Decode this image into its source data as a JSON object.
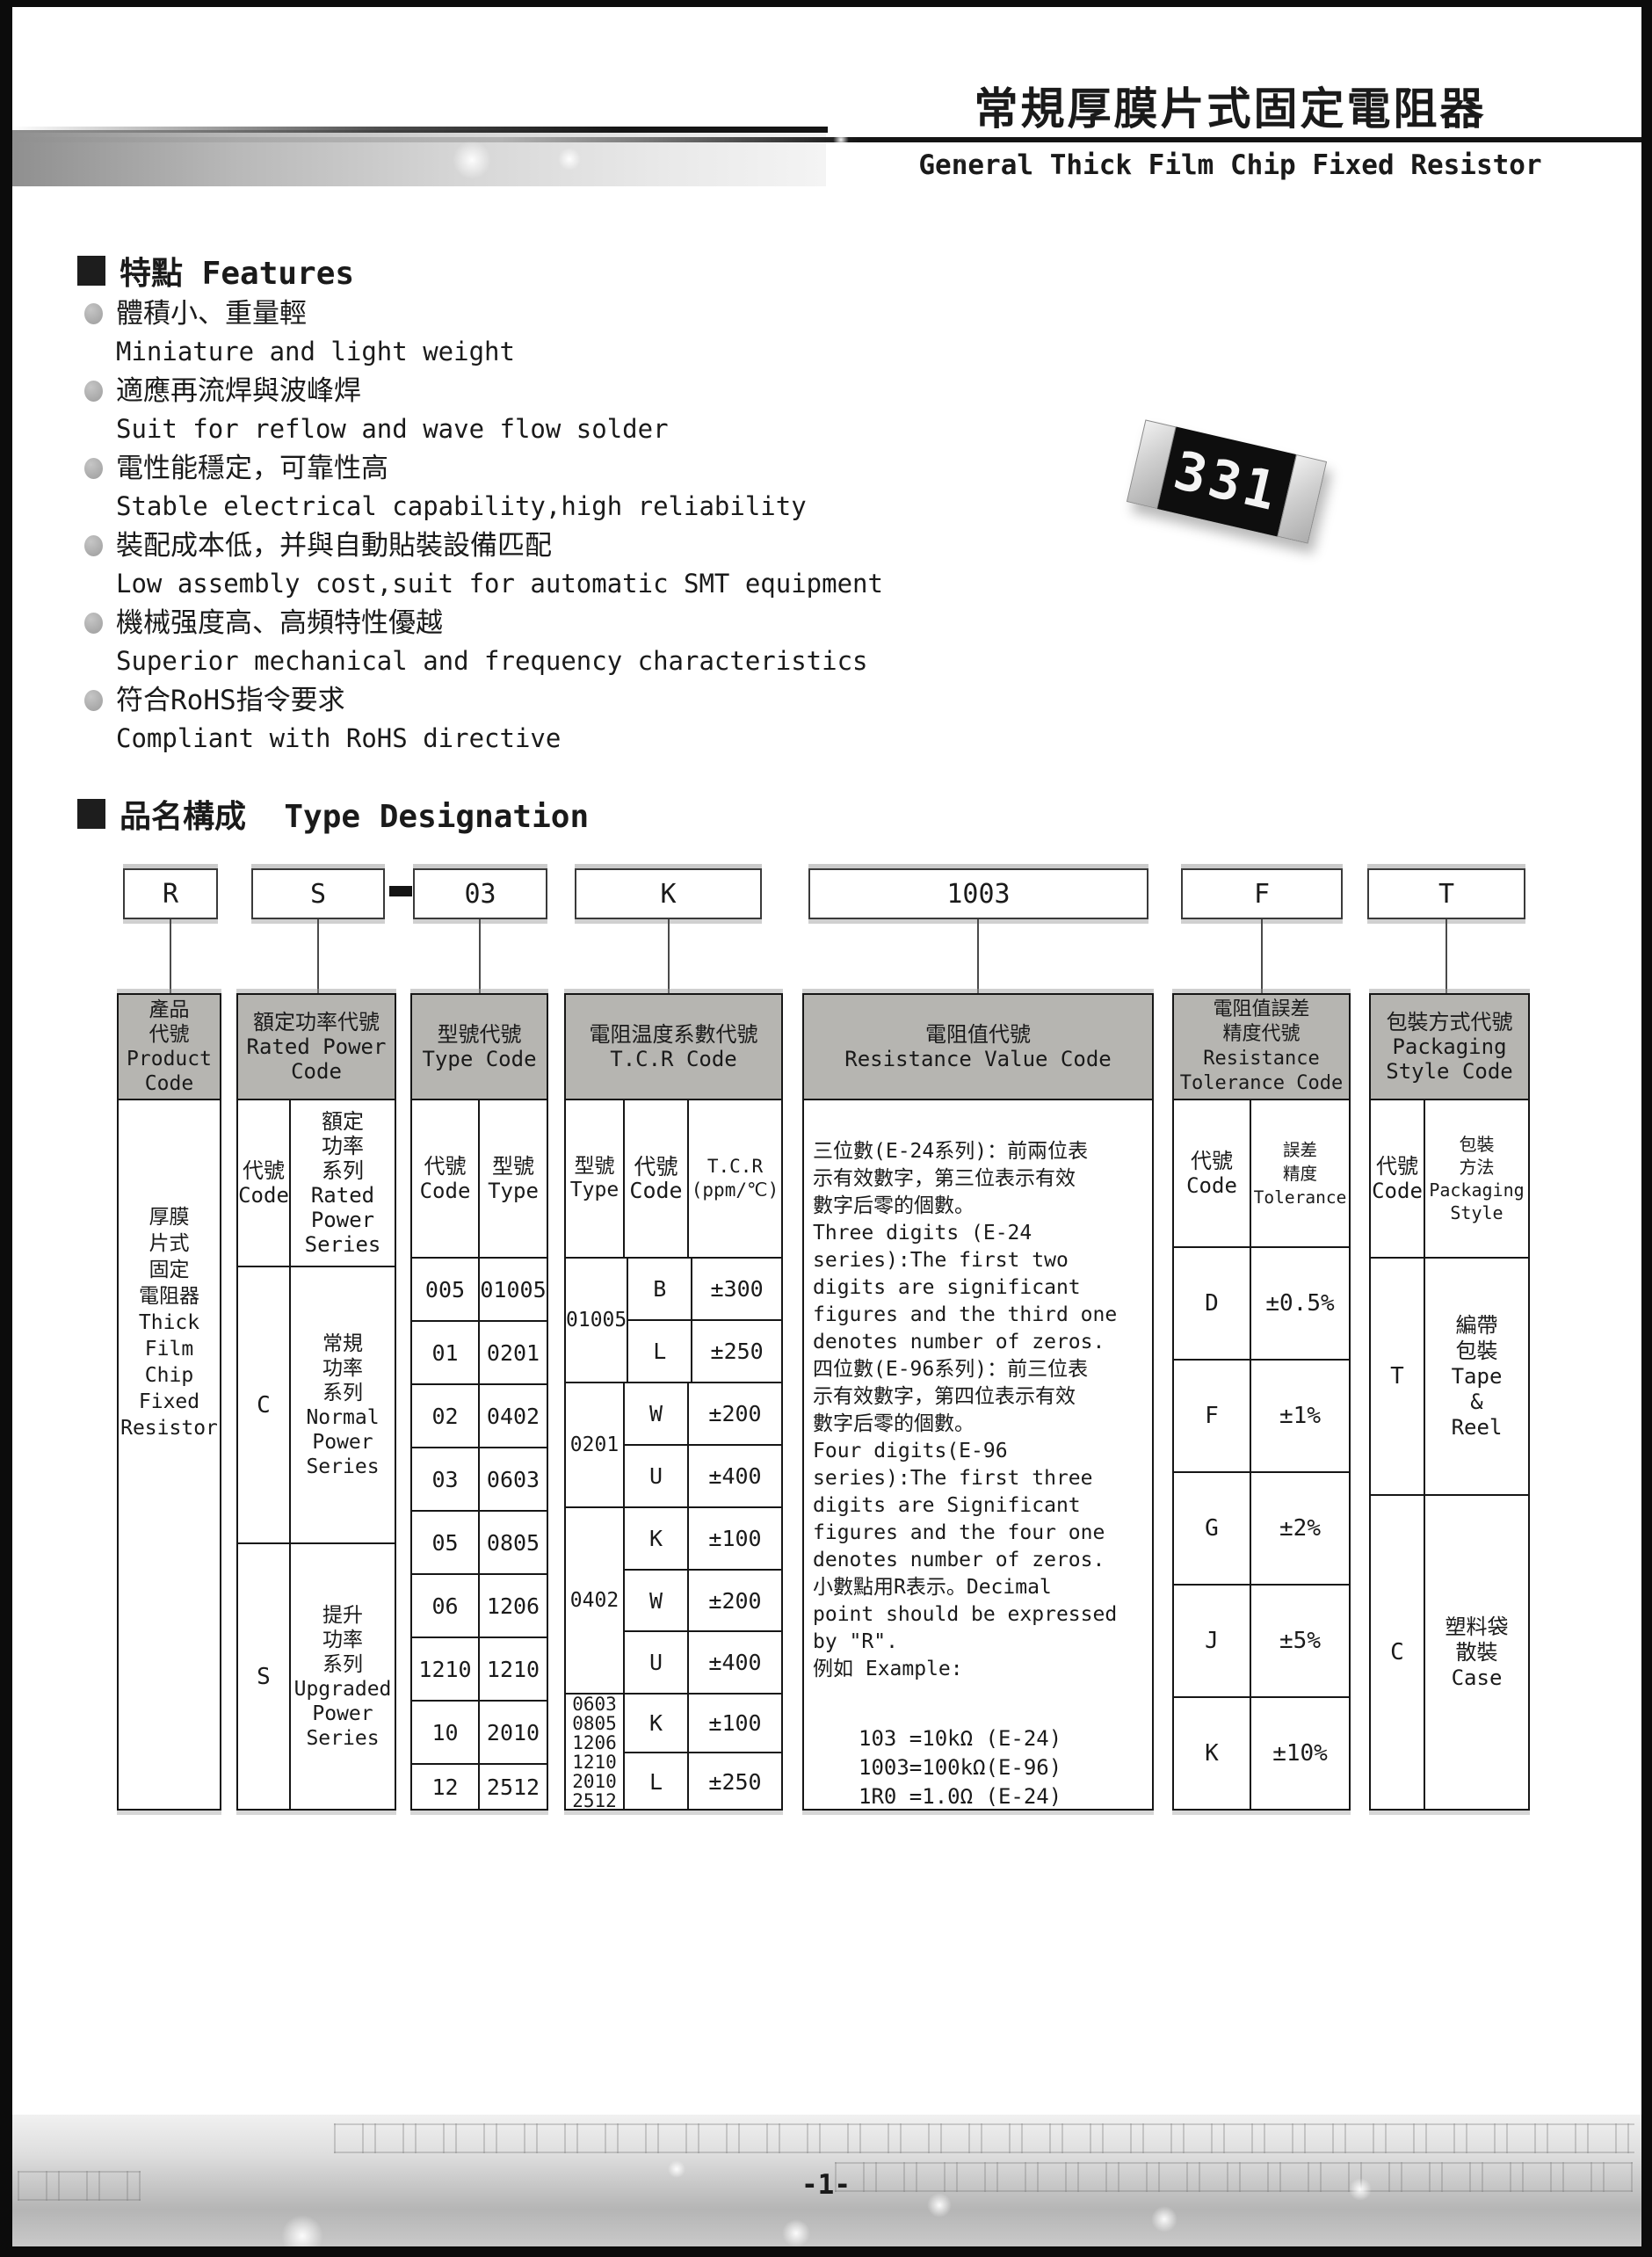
{
  "header": {
    "title_cn": "常規厚膜片式固定電阻器",
    "title_en": "General Thick Film Chip Fixed Resistor"
  },
  "features": {
    "heading": "特點 Features",
    "items": [
      {
        "cn": "體積小、重量輕",
        "en": "Miniature and light weight"
      },
      {
        "cn": "適應再流焊與波峰焊",
        "en": "Suit for reflow and wave flow solder"
      },
      {
        "cn": "電性能穩定，可靠性高",
        "en": "Stable electrical capability,high reliability"
      },
      {
        "cn": "裝配成本低，并與自動貼裝設備匹配",
        "en": "Low assembly cost,suit for automatic SMT equipment"
      },
      {
        "cn": "機械强度高、高頻特性優越",
        "en": "Superior mechanical and frequency characteristics"
      },
      {
        "cn": "符合RoHS指令要求",
        "en": "Compliant with RoHS directive"
      }
    ],
    "resistor_marking": "331"
  },
  "type_designation": {
    "heading": "品名構成  Type Designation",
    "code_boxes": {
      "product": "R",
      "power": "S",
      "separator": "-",
      "type": "03",
      "tcr": "K",
      "resistance": "1003",
      "tolerance": "F",
      "packaging": "T"
    },
    "product_code": {
      "header": "產品\n代號\nProduct\nCode",
      "body": "厚膜\n片式\n固定\n電阻器\nThick\nFilm\nChip\nFixed\nResistor"
    },
    "rated_power": {
      "header": "額定功率代號\nRated Power\nCode",
      "sub_code": "代號\nCode",
      "sub_series": "額定\n功率\n系列\nRated\nPower\nSeries",
      "rows": [
        {
          "code": "C",
          "series": "常規\n功率\n系列\nNormal\nPower\nSeries"
        },
        {
          "code": "S",
          "series": "提升\n功率\n系列\nUpgraded\nPower\nSeries"
        }
      ]
    },
    "type_code": {
      "header": "型號代號\nType Code",
      "sub_code": "代號\nCode",
      "sub_type": "型號\nType",
      "rows": [
        [
          "005",
          "01005"
        ],
        [
          "01",
          "0201"
        ],
        [
          "02",
          "0402"
        ],
        [
          "03",
          "0603"
        ],
        [
          "05",
          "0805"
        ],
        [
          "06",
          "1206"
        ],
        [
          "1210",
          "1210"
        ],
        [
          "10",
          "2010"
        ],
        [
          "12",
          "2512"
        ]
      ]
    },
    "tcr": {
      "header": "電阻温度系數代號\nT.C.R Code",
      "sub_type": "型號\nType",
      "sub_code": "代號\nCode",
      "sub_tcr": "T.C.R\n(ppm/℃)",
      "groups": [
        {
          "type": "01005",
          "rows": [
            [
              "B",
              "±300"
            ],
            [
              "L",
              "±250"
            ]
          ]
        },
        {
          "type": "0201",
          "rows": [
            [
              "W",
              "±200"
            ],
            [
              "U",
              "±400"
            ]
          ]
        },
        {
          "type": "0402",
          "rows": [
            [
              "K",
              "±100"
            ],
            [
              "W",
              "±200"
            ],
            [
              "U",
              "±400"
            ]
          ]
        },
        {
          "type": "0603\n0805\n1206\n1210\n2010\n2512",
          "rows": [
            [
              "K",
              "±100"
            ],
            [
              "L",
              "±250"
            ]
          ]
        }
      ]
    },
    "resistance_value": {
      "header": "電阻值代號\nResistance Value Code",
      "text": "三位數(E-24系列)：前兩位表\n示有效數字，第三位表示有效\n數字后零的個數。\nThree digits (E-24\nseries):The first two\ndigits are significant\nfigures and the third one\ndenotes number of zeros.\n四位數(E-96系列)：前三位表\n示有效數字，第四位表示有效\n數字后零的個數。\nFour digits(E-96\nseries):The first three\ndigits are Significant\nfigures and the four one\ndenotes number of zeros.\n小數點用R表示。Decimal\npoint should be expressed\nby \"R\".\n例如 Example:",
      "examples": "103 =10kΩ (E-24)\n1003=100kΩ(E-96)\n1R0 =1.0Ω (E-24)"
    },
    "tolerance": {
      "header": "電阻值誤差\n精度代號\nResistance\nTolerance Code",
      "sub_code": "代號\nCode",
      "sub_tol": "誤差\n精度\nTolerance",
      "rows": [
        [
          "D",
          "±0.5%"
        ],
        [
          "F",
          "±1%"
        ],
        [
          "G",
          "±2%"
        ],
        [
          "J",
          "±5%"
        ],
        [
          "K",
          "±10%"
        ]
      ]
    },
    "packaging": {
      "header": "包裝方式代號\nPackaging\nStyle Code",
      "sub_code": "代號\nCode",
      "sub_style": "包裝\n方法\nPackaging\nStyle",
      "rows": [
        {
          "code": "T",
          "style": "編帶\n包裝\nTape\n&\nReel"
        },
        {
          "code": "C",
          "style": "塑料袋\n散裝\nCase"
        }
      ]
    }
  },
  "footer": {
    "page_number": "-1-"
  }
}
